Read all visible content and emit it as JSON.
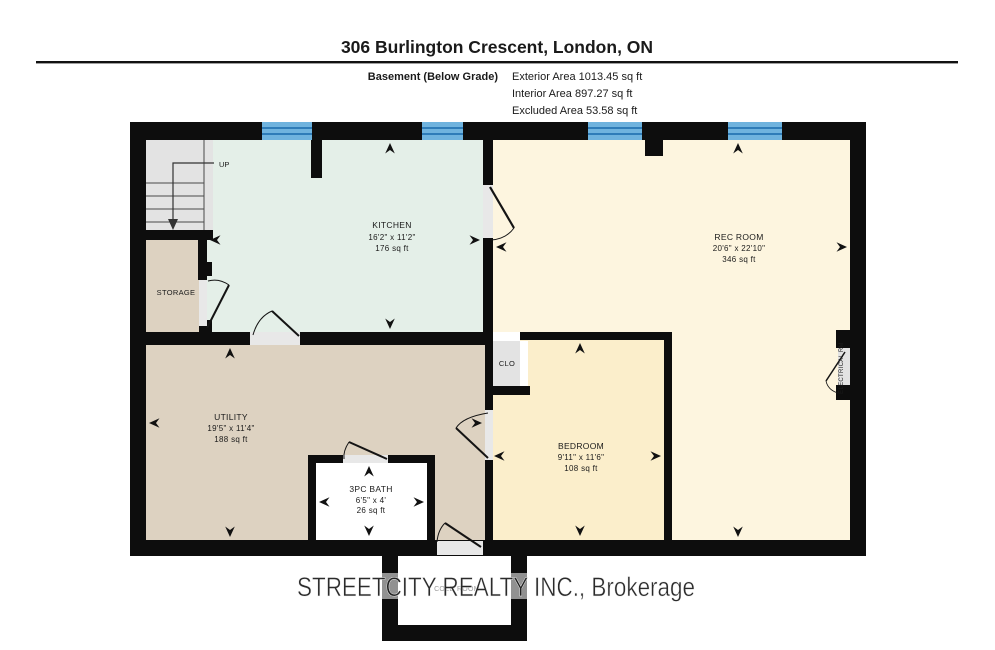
{
  "header": {
    "title": "306 Burlington Crescent, London, ON",
    "floor_label": "Basement (Below Grade)",
    "exterior_area": "Exterior Area 1013.45 sq ft",
    "interior_area": "Interior Area 897.27 sq ft",
    "excluded_area": "Excluded Area 53.58 sq ft"
  },
  "rooms": {
    "kitchen": {
      "name": "KITCHEN",
      "dims": "16'2\" x 11'2\"",
      "area": "176 sq ft"
    },
    "rec_room": {
      "name": "REC ROOM",
      "dims": "20'6\" x 22'10\"",
      "area": "346 sq ft"
    },
    "utility": {
      "name": "UTILITY",
      "dims": "19'5\" x 11'4\"",
      "area": "188 sq ft"
    },
    "bedroom": {
      "name": "BEDROOM",
      "dims": "9'11\" x 11'6\"",
      "area": "108 sq ft"
    },
    "bath": {
      "name": "3PC BATH",
      "dims": "6'5\" x 4'",
      "area": "26 sq ft"
    },
    "storage": {
      "name": "STORAGE"
    },
    "clo": {
      "name": "CLO"
    },
    "cold_room": {
      "name": "COLD ROOM"
    },
    "electrical": {
      "name": "ELECTRICAL RM"
    },
    "stairs": {
      "up_label": "UP"
    }
  },
  "watermark": {
    "text": "STREETCITY REALTY INC., Brokerage"
  },
  "colors": {
    "wall": "#0d0d0d",
    "window_blue": "#6fb3de",
    "window_stripe": "#2e7cb8",
    "kitchen_fill": "#e4efe8",
    "rec_fill": "#fdf5df",
    "bedroom_fill": "#fbeecb",
    "tan_fill": "#ddd2c1",
    "gray_fill": "#e3e3e3",
    "white_fill": "#ffffff"
  }
}
